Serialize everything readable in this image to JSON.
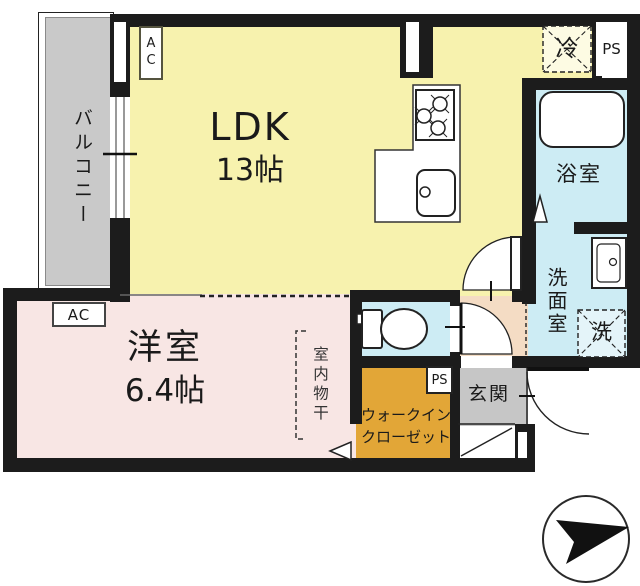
{
  "rooms": {
    "balcony": {
      "label": "バルコニー"
    },
    "ldk": {
      "label": "LDK",
      "size": "13帖"
    },
    "western_room": {
      "label": "洋室",
      "size": "6.4帖"
    },
    "bathroom": {
      "label": "浴室"
    },
    "washroom": {
      "label": "洗面室"
    },
    "entrance": {
      "label": "玄関"
    },
    "walk_in_closet": {
      "label_line1": "ウォークイン",
      "label_line2": "クローゼット"
    }
  },
  "labels": {
    "refrigerator": "冷",
    "washing_machine": "洗",
    "indoor_drying": "室内物干",
    "pipe_space_top": "PS",
    "pipe_space_closet": "PS",
    "ac_ldk": "AC",
    "ac_western_room": "AC"
  },
  "icons": {
    "north_arrow": "compass arrow pointing right"
  },
  "colors": {
    "ldk_fill": "#f7f2ae",
    "western_room_fill": "#f8e6e4",
    "wet_area_fill": "#cdecf4",
    "closet_fill": "#e2a637",
    "entrance_fill": "#c6c6c6",
    "balcony_fill": "#c9c9c9",
    "hallway_fill": "#f4dcc4",
    "wall": "#1c1c1c"
  }
}
